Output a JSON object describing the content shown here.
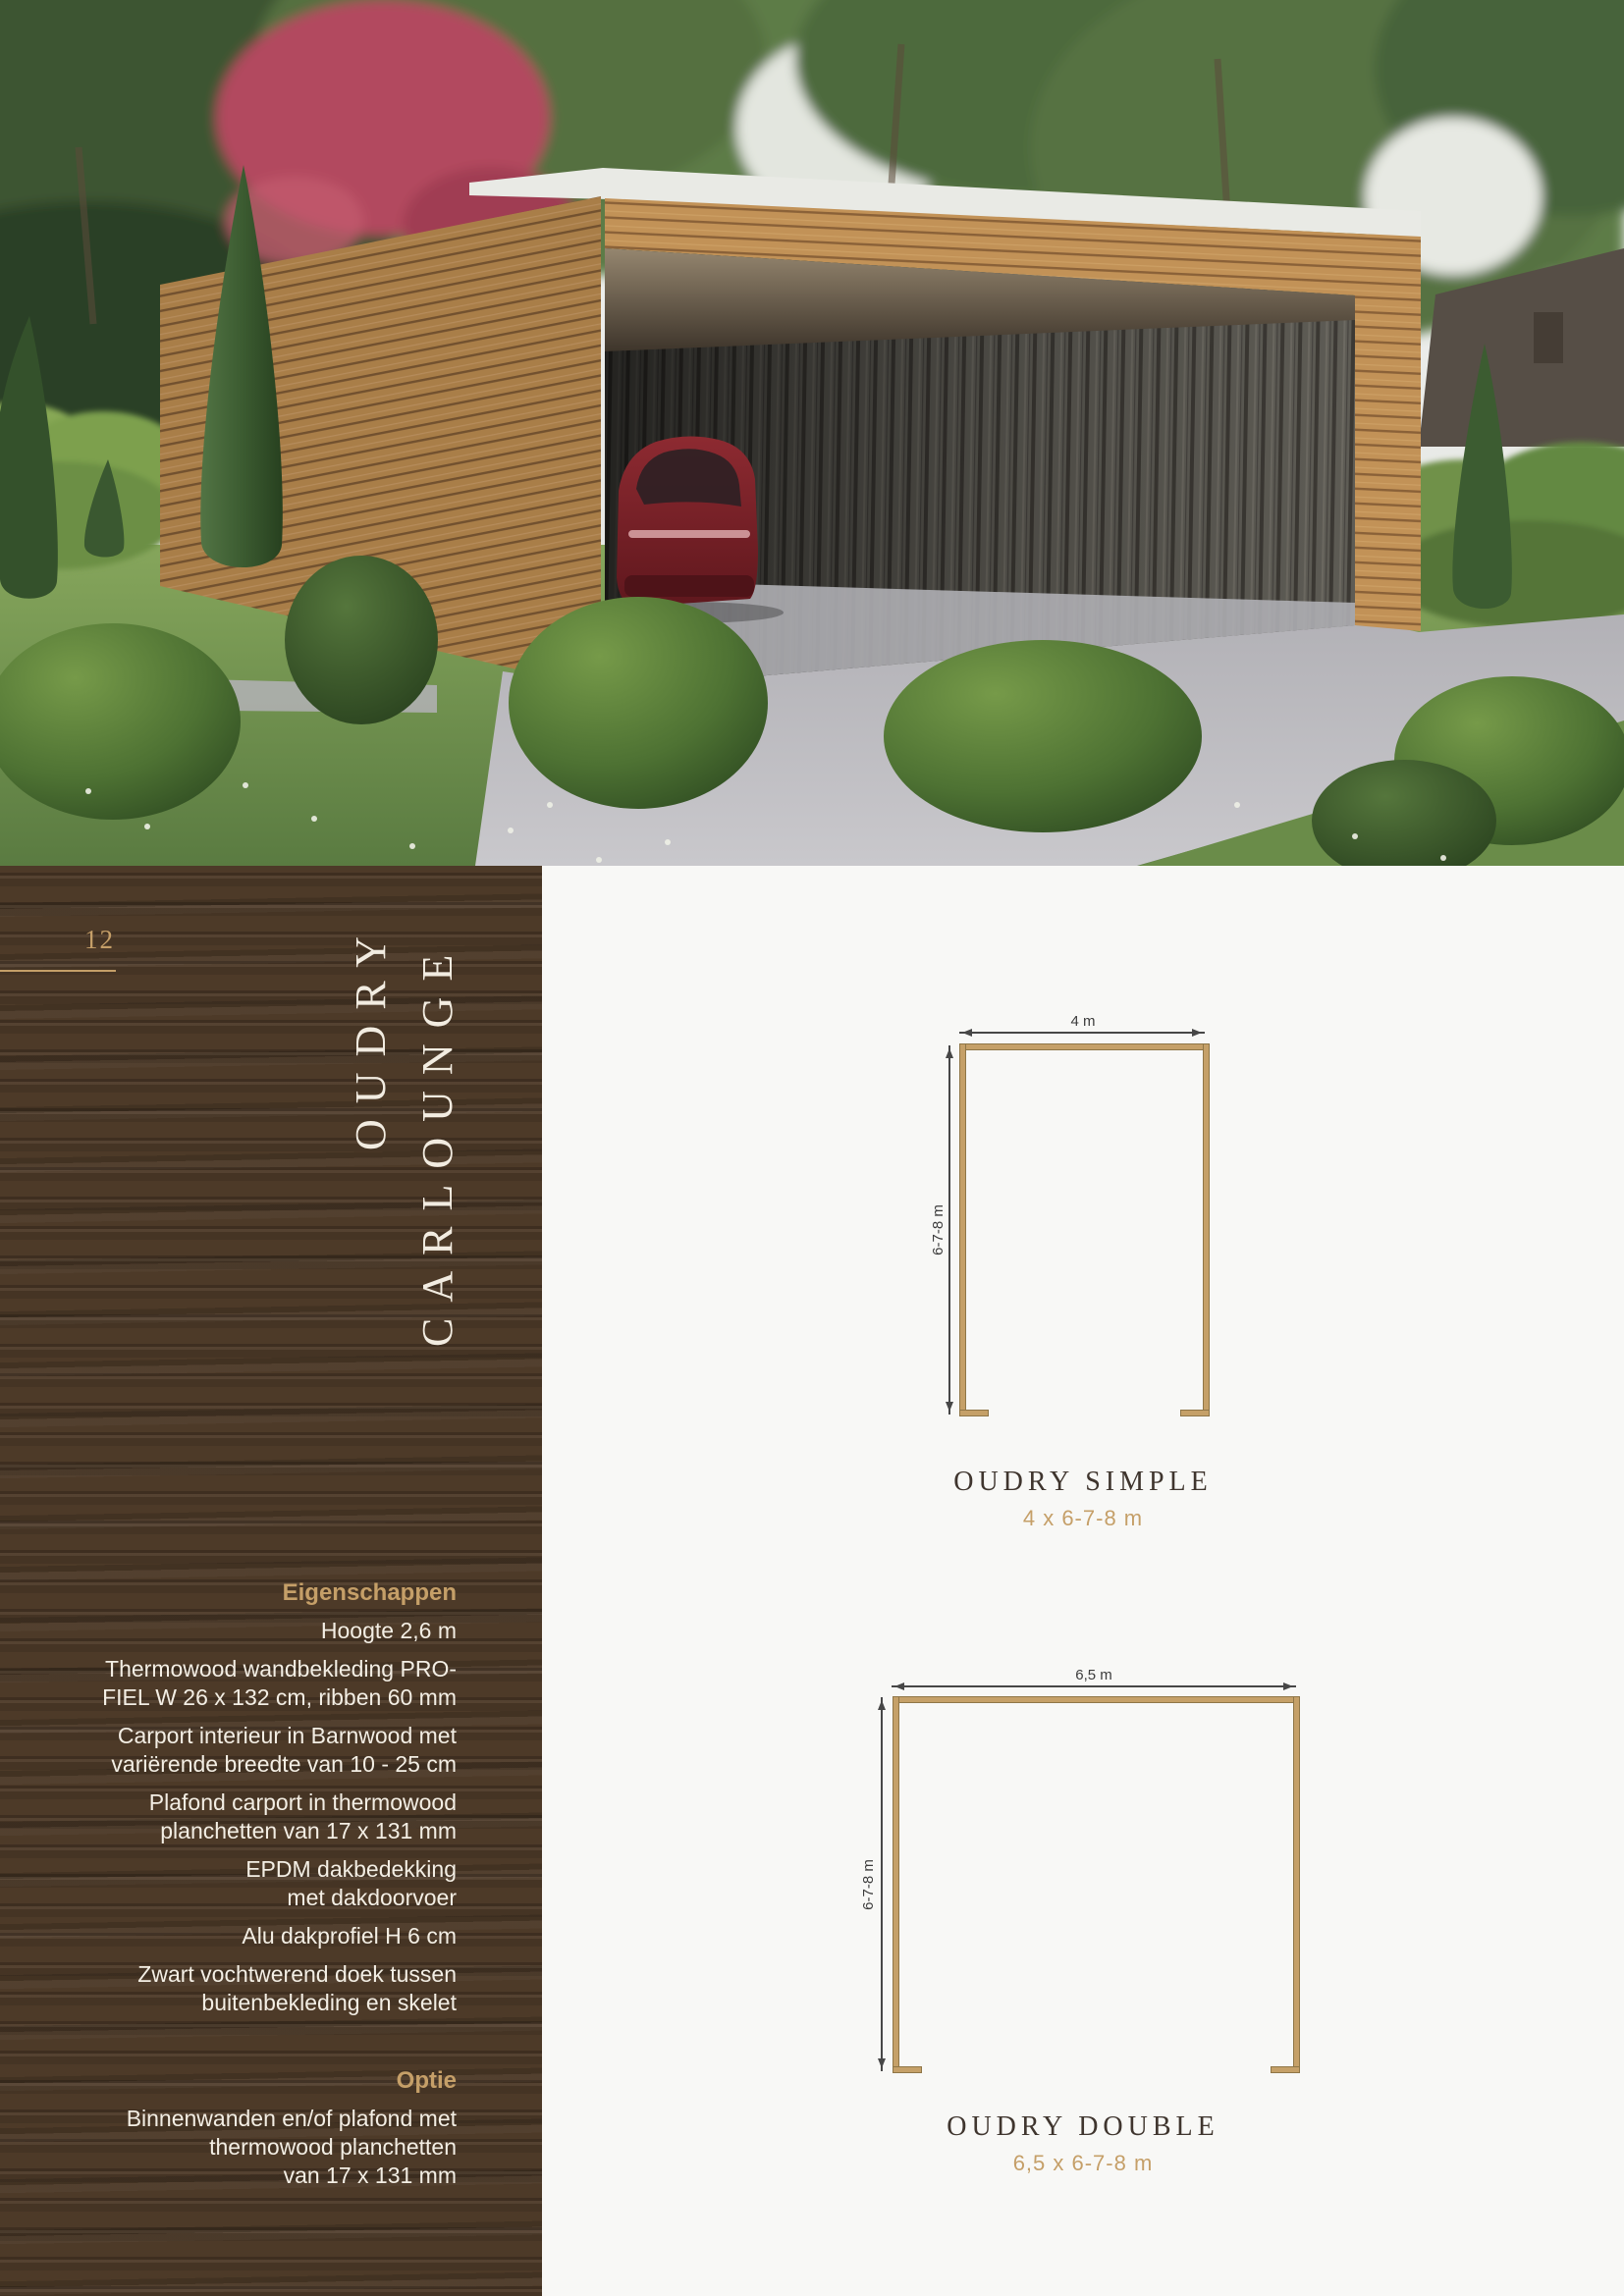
{
  "page": {
    "number": "12",
    "background": "#f8f8f6"
  },
  "sidebar": {
    "brand": {
      "line1": "OUDRY",
      "line2": "CARLOUNGE"
    },
    "specs_heading": "Eigenschappen",
    "specs": [
      "Hoogte 2,6 m",
      "Thermowood wandbekleding PRO-\nFIEL W 26 x 132 cm, ribben 60 mm",
      "Carport interieur in Barnwood met\nvariërende breedte van 10 - 25 cm",
      "Plafond carport in thermowood\nplanchetten van 17 x 131 mm",
      "EPDM dakbedekking\nmet dakdoorvoer",
      "Alu dakprofiel H 6 cm",
      "Zwart vochtwerend doek tussen\nbuitenbekleding en skelet"
    ],
    "option_heading": "Optie",
    "option_text": "Binnenwanden en/of plafond met\nthermowood planchetten\nvan 17 x 131 mm"
  },
  "diagrams": [
    {
      "title": "OUDRY SIMPLE",
      "subtitle": "4 x 6-7-8 m",
      "width_label": "4 m",
      "depth_label": "6-7-8 m"
    },
    {
      "title": "OUDRY DOUBLE",
      "subtitle": "6,5 x 6-7-8 m",
      "width_label": "6,5 m",
      "depth_label": "6-7-8 m"
    }
  ],
  "photo": {
    "alt": "Modern thermowood carport with barnwood interior and red car, surrounded by boxwood bushes, cypresses and hedges"
  },
  "colors": {
    "accent": "#c59f68",
    "panel": "#4d3a28",
    "title": "#3f352e",
    "wallFill": "#c5a068",
    "wallStroke": "#8f7647",
    "dim": "#474747",
    "specText": "#f3eee4",
    "pageBg": "#f8f8f6"
  }
}
